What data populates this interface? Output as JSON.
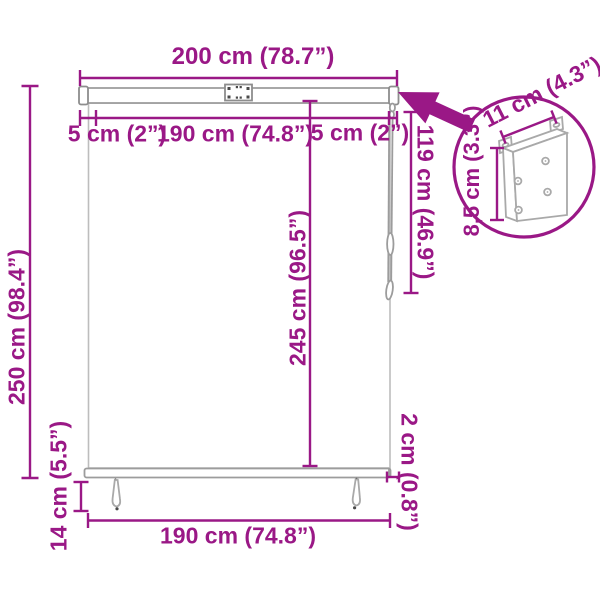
{
  "diagram": {
    "type": "roller-blind-dimension-drawing",
    "accent_color": "#9a1886",
    "line_color": "#a9a9a9",
    "icons": {
      "detail_pointer": "thick-arrow-pointing-to-mount-bracket"
    },
    "dimensions": {
      "total_width": "200 cm (78.7”)",
      "left_margin": "5 cm (2”)",
      "fabric_width": "190 cm (74.8”)",
      "right_margin": "5 cm (2”)",
      "total_height": "250 cm (98.4”)",
      "fabric_height": "245 cm (96.5”)",
      "cord_length": "119 cm (46.9”)",
      "bottom_gap": "2 cm (0.8”)",
      "tassel_drop": "14 cm (5.5”)",
      "bottom_width": "190 cm (74.8”)",
      "bracket_width": "11 cm (4.3”)",
      "bracket_depth": "8,5 cm (3.3”)"
    }
  }
}
